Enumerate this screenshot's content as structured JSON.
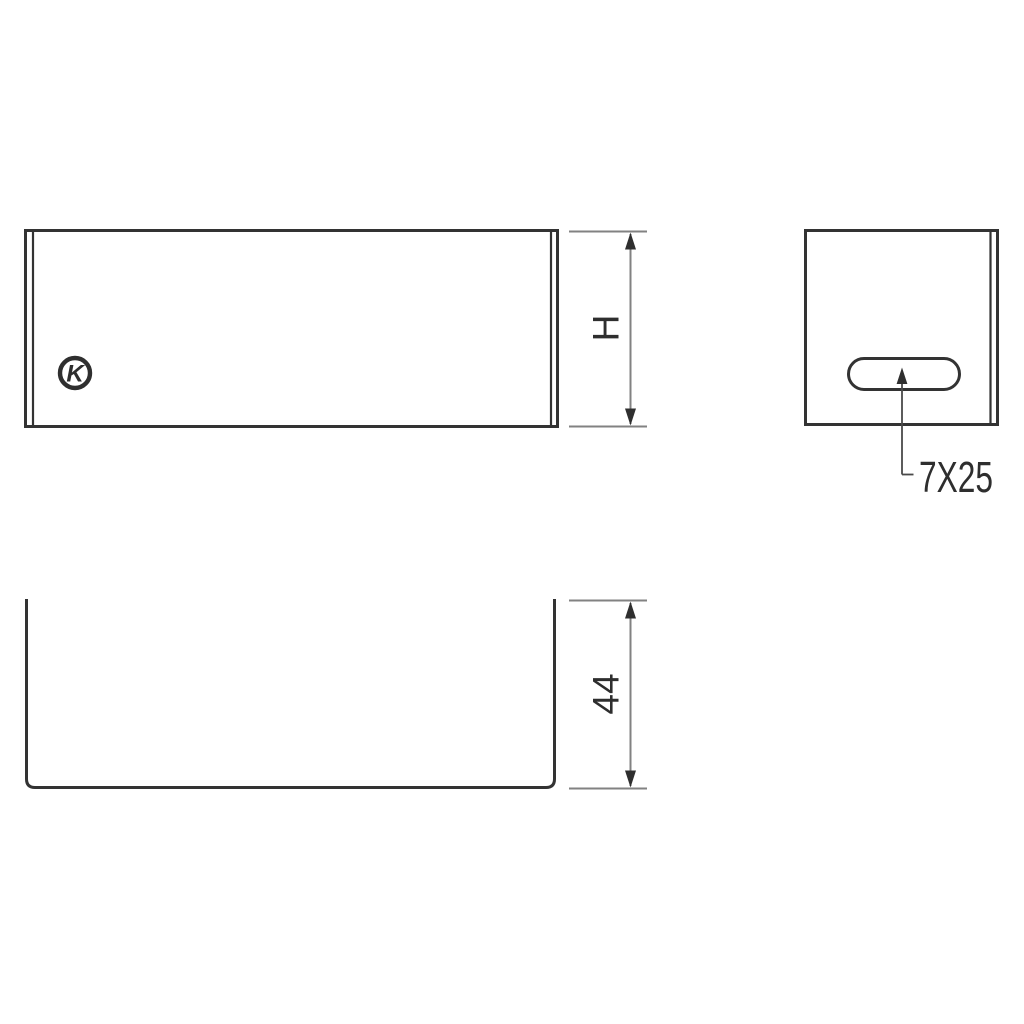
{
  "drawing": {
    "type": "technical-drawing",
    "part": "u-channel-sheet-metal-profile",
    "colors": {
      "background": "#ffffff",
      "outline": "#333333",
      "dimension_line": "#828282",
      "arrowhead": "#2f2f2f",
      "text": "#2e2e2e"
    },
    "logo": {
      "letter": "K"
    },
    "dimensions": {
      "front_height": {
        "label": "H"
      },
      "channel_depth": {
        "label": "44"
      },
      "slot": {
        "label": "7X25"
      }
    }
  }
}
